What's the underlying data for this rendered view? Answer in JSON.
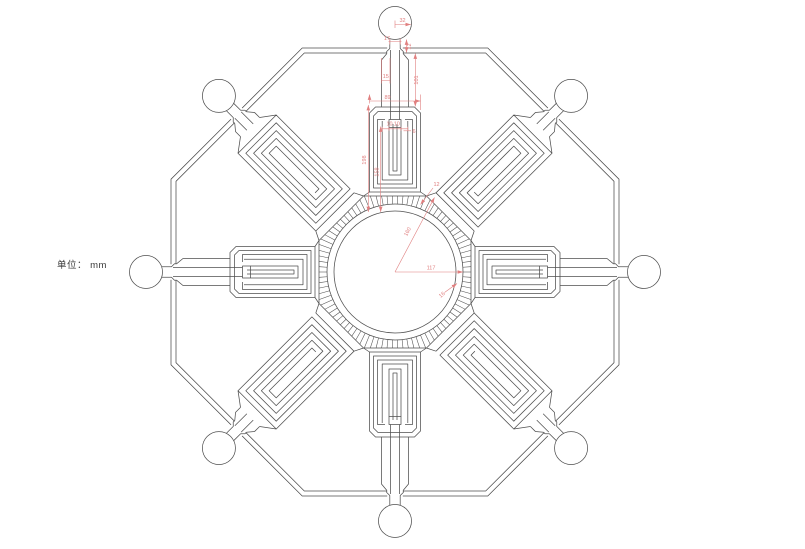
{
  "page": {
    "units_label": "单位： mm"
  },
  "colors": {
    "line": "#4f4f4f",
    "dimension": "#e07f7f",
    "background": "#ffffff"
  },
  "drawing": {
    "kind": "symmetric-octagonal-part",
    "arm_count": 8,
    "port_circle_count": 8
  },
  "dimensions": {
    "port_radius": "32",
    "neck_width": "17",
    "neck_length": "12",
    "channel_pitch": "15",
    "channel_length": "101",
    "arm_width": "89",
    "slot_left": "10",
    "slot_right": "10",
    "slot_wall": "6",
    "arm_length": "198",
    "slot_length": "158",
    "fin_ring_width": "12",
    "radius_angled": "160",
    "radius_horizontal": "117",
    "ring_wall": "16"
  }
}
